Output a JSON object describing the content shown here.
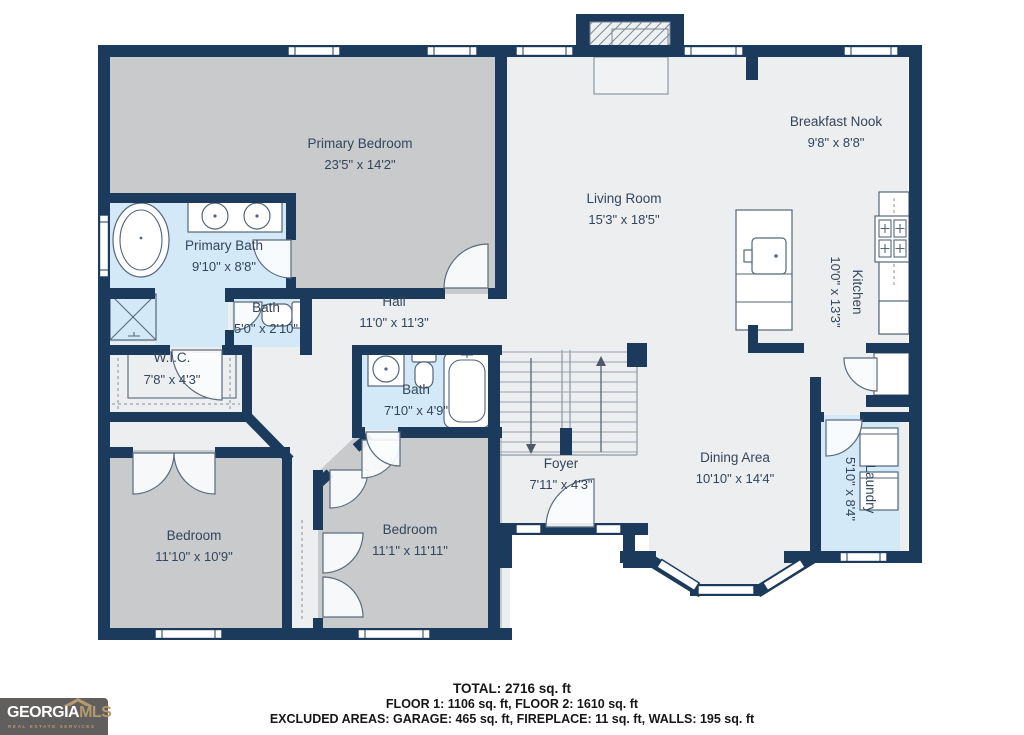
{
  "rooms": {
    "primary_bedroom": {
      "name": "Primary Bedroom",
      "dims": "23'5\" x 14'2\""
    },
    "primary_bath": {
      "name": "Primary Bath",
      "dims": "9'10\" x 8'8\""
    },
    "bath_small": {
      "name": "Bath",
      "dims": "5'0\" x 2'10\""
    },
    "wic": {
      "name": "W.I.C.",
      "dims": "7'8\" x 4'3\""
    },
    "hall": {
      "name": "Hall",
      "dims": "11'0\" x 11'3\""
    },
    "living_room": {
      "name": "Living Room",
      "dims": "15'3\" x 18'5\""
    },
    "breakfast_nook": {
      "name": "Breakfast Nook",
      "dims": "9'8\" x 8'8\""
    },
    "kitchen": {
      "name": "Kitchen",
      "dims": "10'0\" x 13'3\""
    },
    "bath_hall": {
      "name": "Bath",
      "dims": "7'10\" x 4'9\""
    },
    "foyer": {
      "name": "Foyer",
      "dims": "7'11\" x 4'3\""
    },
    "dining_area": {
      "name": "Dining Area",
      "dims": "10'10\" x 14'4\""
    },
    "laundry": {
      "name": "Laundry",
      "dims": "5'10\" x 8'4\""
    },
    "bedroom_left": {
      "name": "Bedroom",
      "dims": "11'10\" x 10'9\""
    },
    "bedroom_right": {
      "name": "Bedroom",
      "dims": "11'1\" x 11'11\""
    }
  },
  "footer": {
    "total": "TOTAL: 2716 sq. ft",
    "floors": "FLOOR 1: 1106 sq. ft, FLOOR 2: 1610 sq. ft",
    "excluded": "EXCLUDED AREAS: GARAGE: 465 sq. ft, FIREPLACE: 11 sq. ft, WALLS: 195 sq. ft"
  },
  "logo": {
    "brand_primary": "GEORGIA",
    "brand_secondary": "MLS",
    "tagline": "REAL ESTATE SERVICES"
  },
  "colors": {
    "wall": "#1c3a5c",
    "floor_light": "#eceef0",
    "room_gray": "#c9cacc",
    "room_blue": "#d3e9f7",
    "label_text": "#33455c",
    "logo_bg": "#615f5e",
    "logo_accent": "#b49a6d"
  }
}
